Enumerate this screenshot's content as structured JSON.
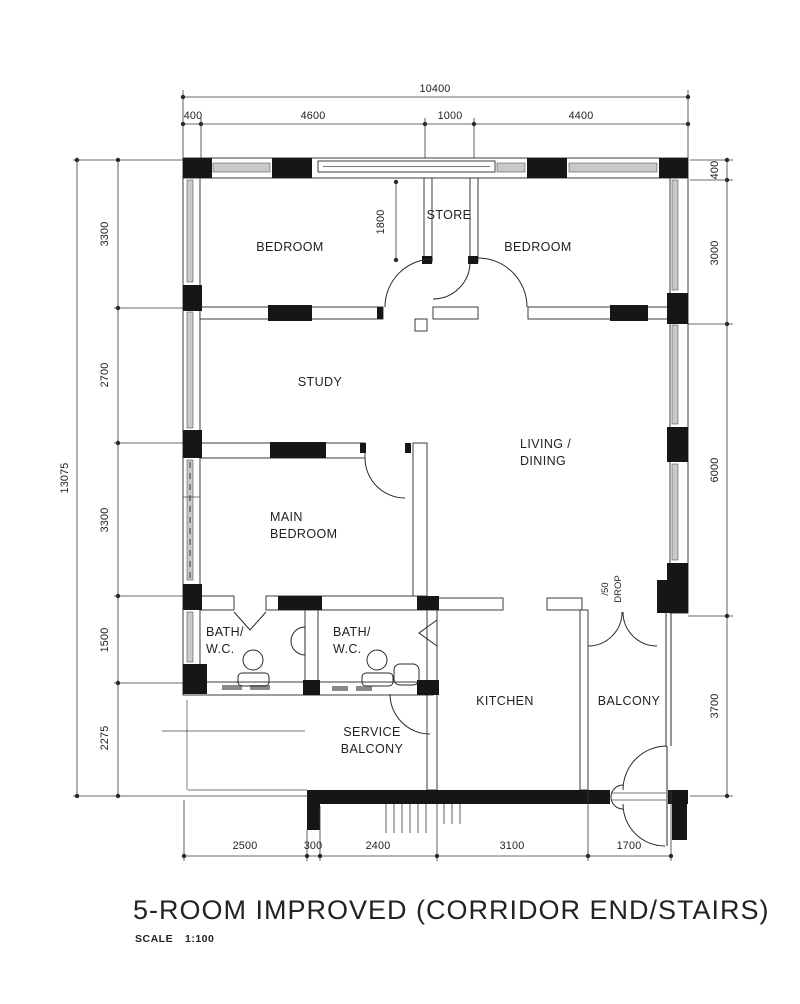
{
  "title": "5-ROOM IMPROVED (CORRIDOR END/STAIRS)",
  "scale_label": "SCALE",
  "scale_value": "1:100",
  "ink_color": "#1f1f1f",
  "paper_color": "#ffffff",
  "rooms": {
    "bedroom_left": "BEDROOM",
    "bedroom_right": "BEDROOM",
    "store": "STORE",
    "study": "STUDY",
    "living_line1": "LIVING /",
    "living_line2": "DINING",
    "main_bedroom_line1": "MAIN",
    "main_bedroom_line2": "BEDROOM",
    "bath1_line1": "BATH/",
    "bath1_line2": "W.C.",
    "bath2_line1": "BATH/",
    "bath2_line2": "W.C.",
    "kitchen": "KITCHEN",
    "balcony": "BALCONY",
    "service_balcony_line1": "SERVICE",
    "service_balcony_line2": "BALCONY"
  },
  "dimensions": {
    "top_total": "10400",
    "top": [
      "400",
      "4600",
      "1000",
      "4400"
    ],
    "left_total": "13075",
    "left": [
      "3300",
      "2700",
      "3300",
      "1500",
      "2275"
    ],
    "right": [
      "400",
      "3000",
      "6000",
      "3700"
    ],
    "bottom": [
      "2500",
      "300",
      "2400",
      "3100",
      "1700"
    ],
    "store_depth": "1800",
    "drop_note_line1": "/50",
    "drop_note_line2": "DROP"
  }
}
